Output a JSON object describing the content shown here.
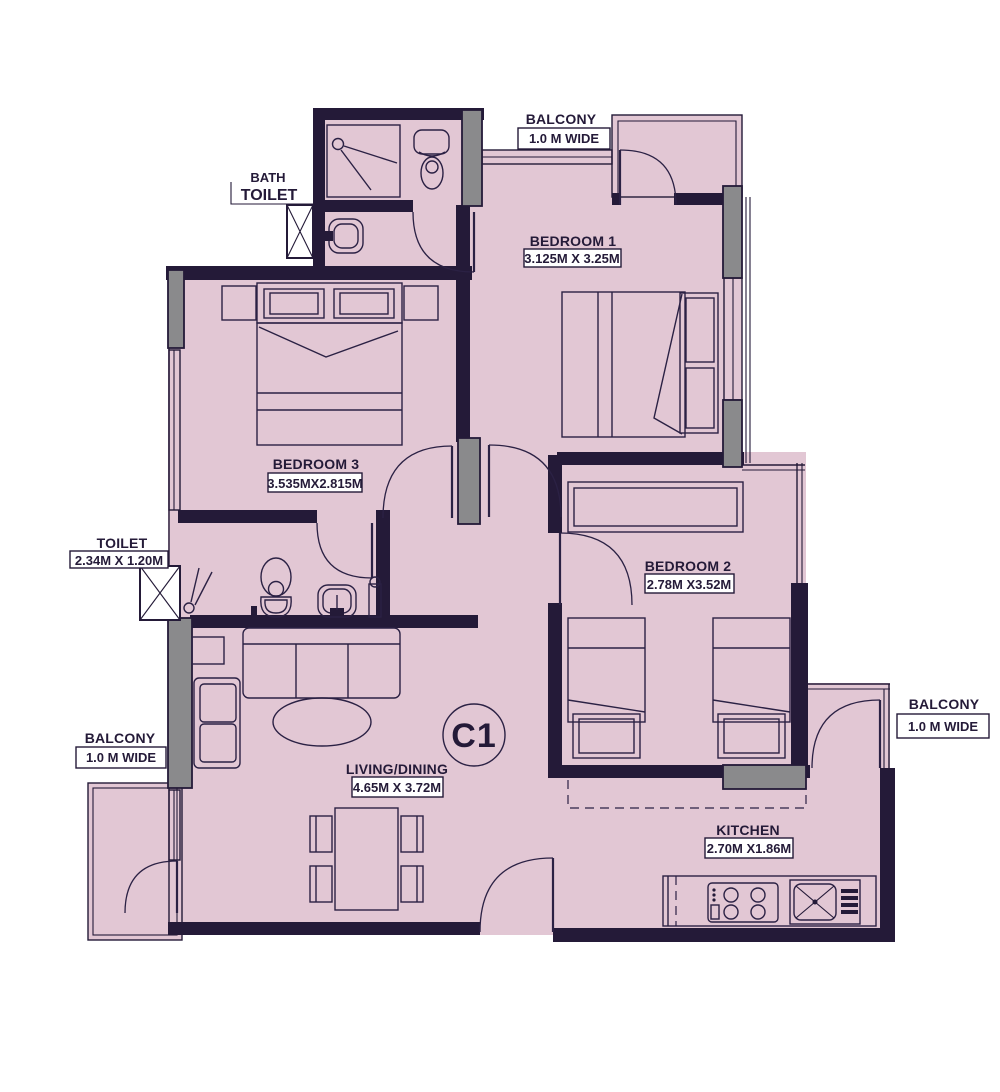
{
  "unit": {
    "label": "C1"
  },
  "colors": {
    "floor": "#e2c7d4",
    "wall": "#241a38",
    "column_grey": "#8a8a8c",
    "background": "#ffffff"
  },
  "rooms": {
    "bedroom1": {
      "name": "BEDROOM 1",
      "dims": "3.125M X 3.25M"
    },
    "bedroom2": {
      "name": "BEDROOM 2",
      "dims": "2.78M X3.52M"
    },
    "bedroom3": {
      "name": "BEDROOM 3",
      "dims": "3.535MX2.815M"
    },
    "living": {
      "name": "LIVING/DINING",
      "dims": "4.65M X 3.72M"
    },
    "kitchen": {
      "name": "KITCHEN",
      "dims": "2.70M X1.86M"
    },
    "toilet": {
      "name": "TOILET",
      "dims": "2.34M X 1.20M"
    },
    "bath_toilet": {
      "line1": "BATH",
      "line2": "TOILET"
    },
    "balcony_top": {
      "name": "BALCONY",
      "dims": "1.0 M WIDE"
    },
    "balcony_left": {
      "name": "BALCONY",
      "dims": "1.0 M WIDE"
    },
    "balcony_right": {
      "name": "BALCONY",
      "dims": "1.0 M WIDE"
    }
  }
}
